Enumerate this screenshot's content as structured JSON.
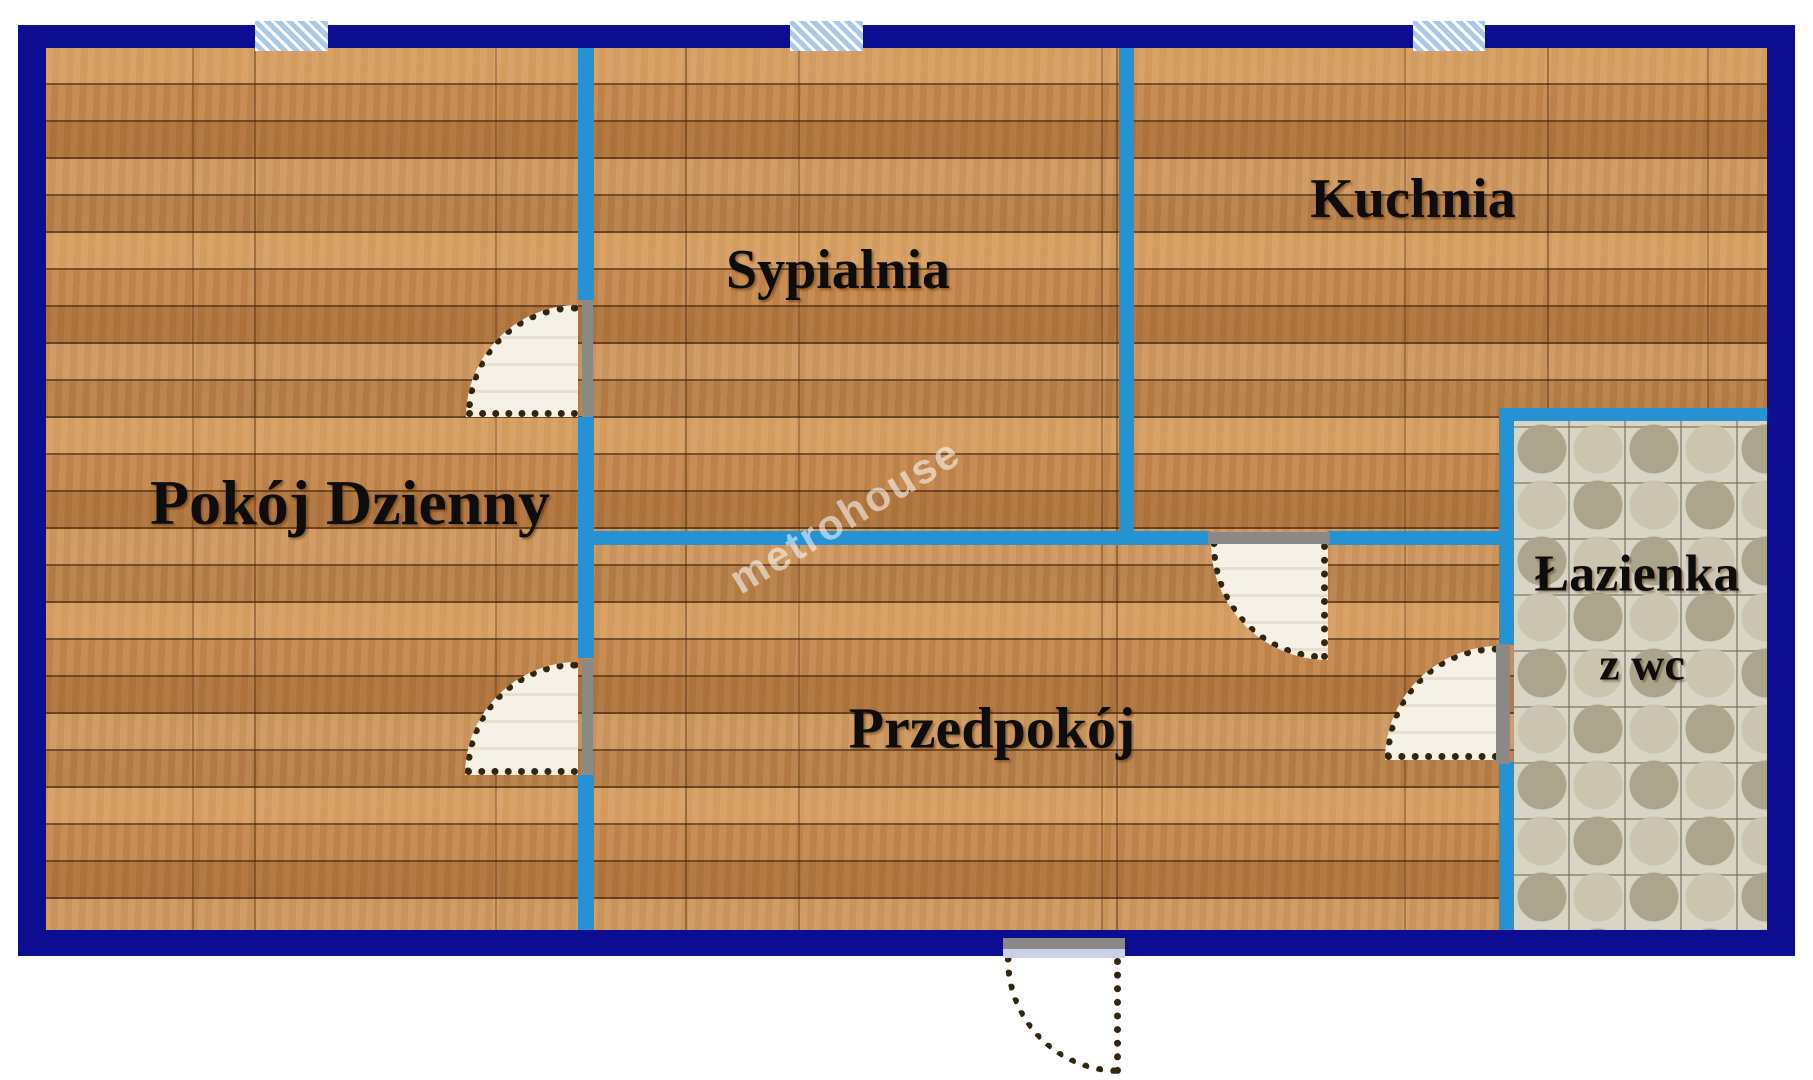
{
  "watermark": "metrohouse",
  "rooms": [
    {
      "id": "pokoj-dzienny",
      "label": "Pokój Dzienny"
    },
    {
      "id": "sypialnia",
      "label": "Sypialnia"
    },
    {
      "id": "kuchnia",
      "label": "Kuchnia"
    },
    {
      "id": "przedpokoj",
      "label": "Przedpokój"
    },
    {
      "id": "lazienka-z-wc",
      "label": "Łazienka",
      "label_line2": "z wc"
    }
  ],
  "colors": {
    "outer_wall": "#0c0d90",
    "inner_wall": "#2592d3",
    "wood_floor_base": "#c4874c",
    "bathroom_tile": "#d9d5c5",
    "window_fill": "#a9c9ea",
    "door_leaf_fill": "#f5f0e5",
    "door_frame_grey": "#8b8984",
    "entrance_sill": "#ccd1ea",
    "label_text": "#0d0d0d",
    "watermark_text": "rgba(255,255,255,0.55)"
  }
}
